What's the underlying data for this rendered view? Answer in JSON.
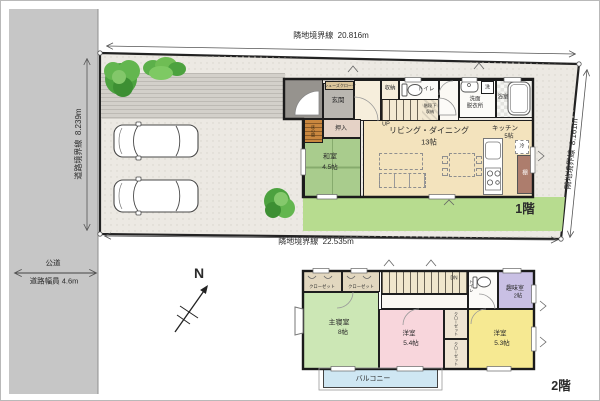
{
  "palette": {
    "wall": "#1e1e1e",
    "road_gray": "#c6c6c6",
    "site_gravel": "#ece9e3",
    "garden_green": "#b7dc8f",
    "tatami_green": "#a9cc8d",
    "living_beige": "#f3e3bd",
    "master_green": "#cce7b5",
    "west_room_pink": "#f8d6dc",
    "west_room_yellow": "#f6e992",
    "hobby_purple": "#c9c0e4",
    "balcony_blue": "#cfe7f3",
    "tokonoma_orange": "#c9873f",
    "shelf_brown": "#ad7d6d",
    "tree_green": "#4ca23f"
  },
  "site": {
    "boundary_top_label": "隣地境界線",
    "boundary_top_length": "20.816m",
    "boundary_bottom_label": "隣地境界線",
    "boundary_bottom_length": "22.535m",
    "boundary_left_label": "道路境界線",
    "boundary_left_length": "8.239m",
    "boundary_right_label": "隣地境界線",
    "boundary_right_length": "8.161m",
    "road_name": "公道",
    "road_width_label": "道路幅員",
    "road_width_value": "4.6m",
    "north": "N"
  },
  "floor1": {
    "label": "1階",
    "genkan": "玄関",
    "shoes_closet": "シューズクローク",
    "storage": "収納",
    "toilet": "トイレ",
    "stairs": "UP",
    "under_stairs_line1": "階段下",
    "under_stairs_line2": "収納",
    "washroom_line1": "洗面",
    "washroom_line2": "脱衣所",
    "washer": "洗",
    "bathroom": "浴室",
    "living_line1": "リビング・ダイニング",
    "living_line2": "13帖",
    "kitchen_line1": "キッチン",
    "kitchen_line2": "5帖",
    "fridge": "冷",
    "shelf": "棚",
    "oshiire": "押入",
    "tokonoma": "床の間",
    "washitsu_line1": "和室",
    "washitsu_line2": "4.5帖"
  },
  "floor2": {
    "label": "2階",
    "closet_left": "クローゼット",
    "closet_right": "クローゼット",
    "stairs": "DN",
    "toilet": "トイレ",
    "hobby_line1": "趣味室",
    "hobby_line2": "2帖",
    "master_line1": "主寝室",
    "master_line2": "8帖",
    "west_a_line1": "洋室",
    "west_a_line2": "5.4帖",
    "closet_a": "クローゼット",
    "closet_b": "クローゼット",
    "west_b_line1": "洋室",
    "west_b_line2": "5.3帖",
    "balcony": "バルコニー"
  }
}
